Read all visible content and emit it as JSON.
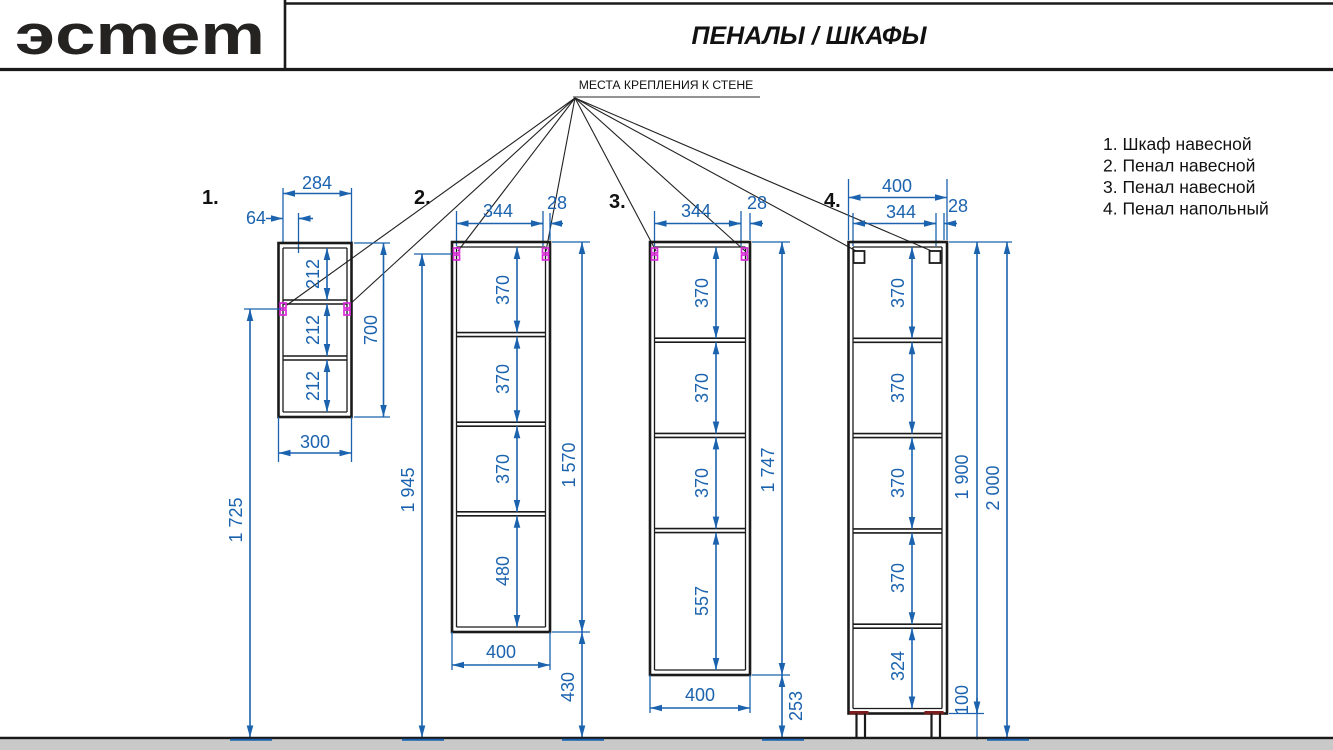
{
  "header": {
    "brand": "эcmem",
    "title": "ПЕНАЛЫ / ШКАФЫ"
  },
  "annotations": {
    "wall_mount": "МЕСТА КРЕПЛЕНИЯ К СТЕНЕ"
  },
  "legend": {
    "items": [
      "1. Шкаф навесной",
      "2. Пенал навесной",
      "3. Пенал навесной",
      "4. Пенал напольный"
    ]
  },
  "cabinets": [
    {
      "label": "1.",
      "dims": {
        "top": "284",
        "offset": "64",
        "bottom": "300",
        "height": "700",
        "to_floor": "1 725"
      },
      "sections": [
        "212",
        "212",
        "212"
      ]
    },
    {
      "label": "2.",
      "dims": {
        "inner": "344",
        "wall": "28",
        "bottom": "400",
        "height": "1 570",
        "mount_to_floor": "1 945",
        "floor_gap": "430"
      },
      "sections": [
        "370",
        "370",
        "370",
        "480"
      ]
    },
    {
      "label": "3.",
      "dims": {
        "inner": "344",
        "wall": "28",
        "bottom": "400",
        "height": "1 747",
        "floor_gap": "253"
      },
      "sections": [
        "370",
        "370",
        "370",
        "557"
      ]
    },
    {
      "label": "4.",
      "dims": {
        "top": "400",
        "inner": "344",
        "wall": "28",
        "height": "1 900",
        "total": "2 000",
        "legs": "100"
      },
      "sections": [
        "370",
        "370",
        "370",
        "370",
        "324"
      ]
    }
  ],
  "colors": {
    "dimension_blue": "#1b63ae",
    "mount_magenta": "#d92bd9",
    "line_black": "#1a1a1a",
    "floor_gray": "#c9c9c9"
  }
}
